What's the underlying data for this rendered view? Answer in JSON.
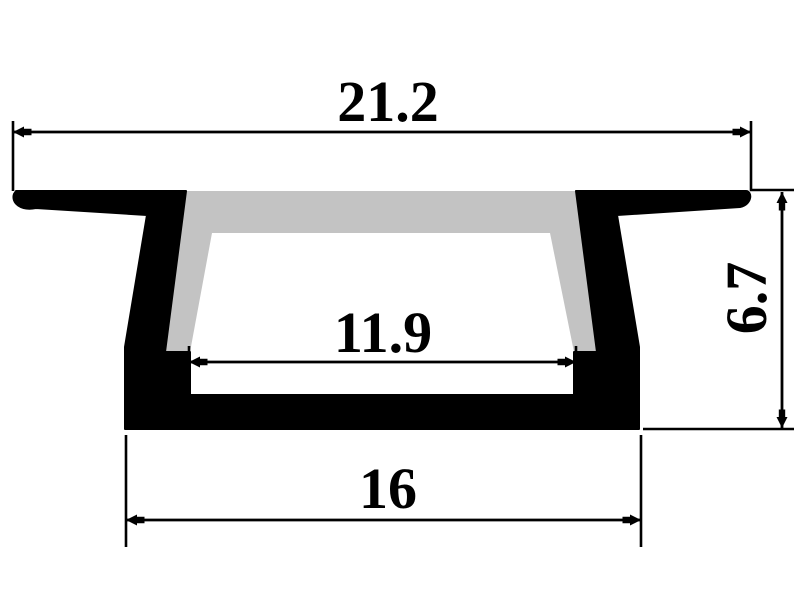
{
  "drawing": {
    "kind": "profile-cross-section",
    "colors": {
      "outline": "#000000",
      "aluminum_fill": "#000000",
      "diffuser_fill": "#c3c3c3",
      "background": "#ffffff"
    },
    "dimensions": {
      "overall_width": {
        "label": "21.2"
      },
      "opening_width": {
        "label": "11.9"
      },
      "base_width": {
        "label": "16"
      },
      "overall_height": {
        "label": "6.7"
      }
    }
  }
}
